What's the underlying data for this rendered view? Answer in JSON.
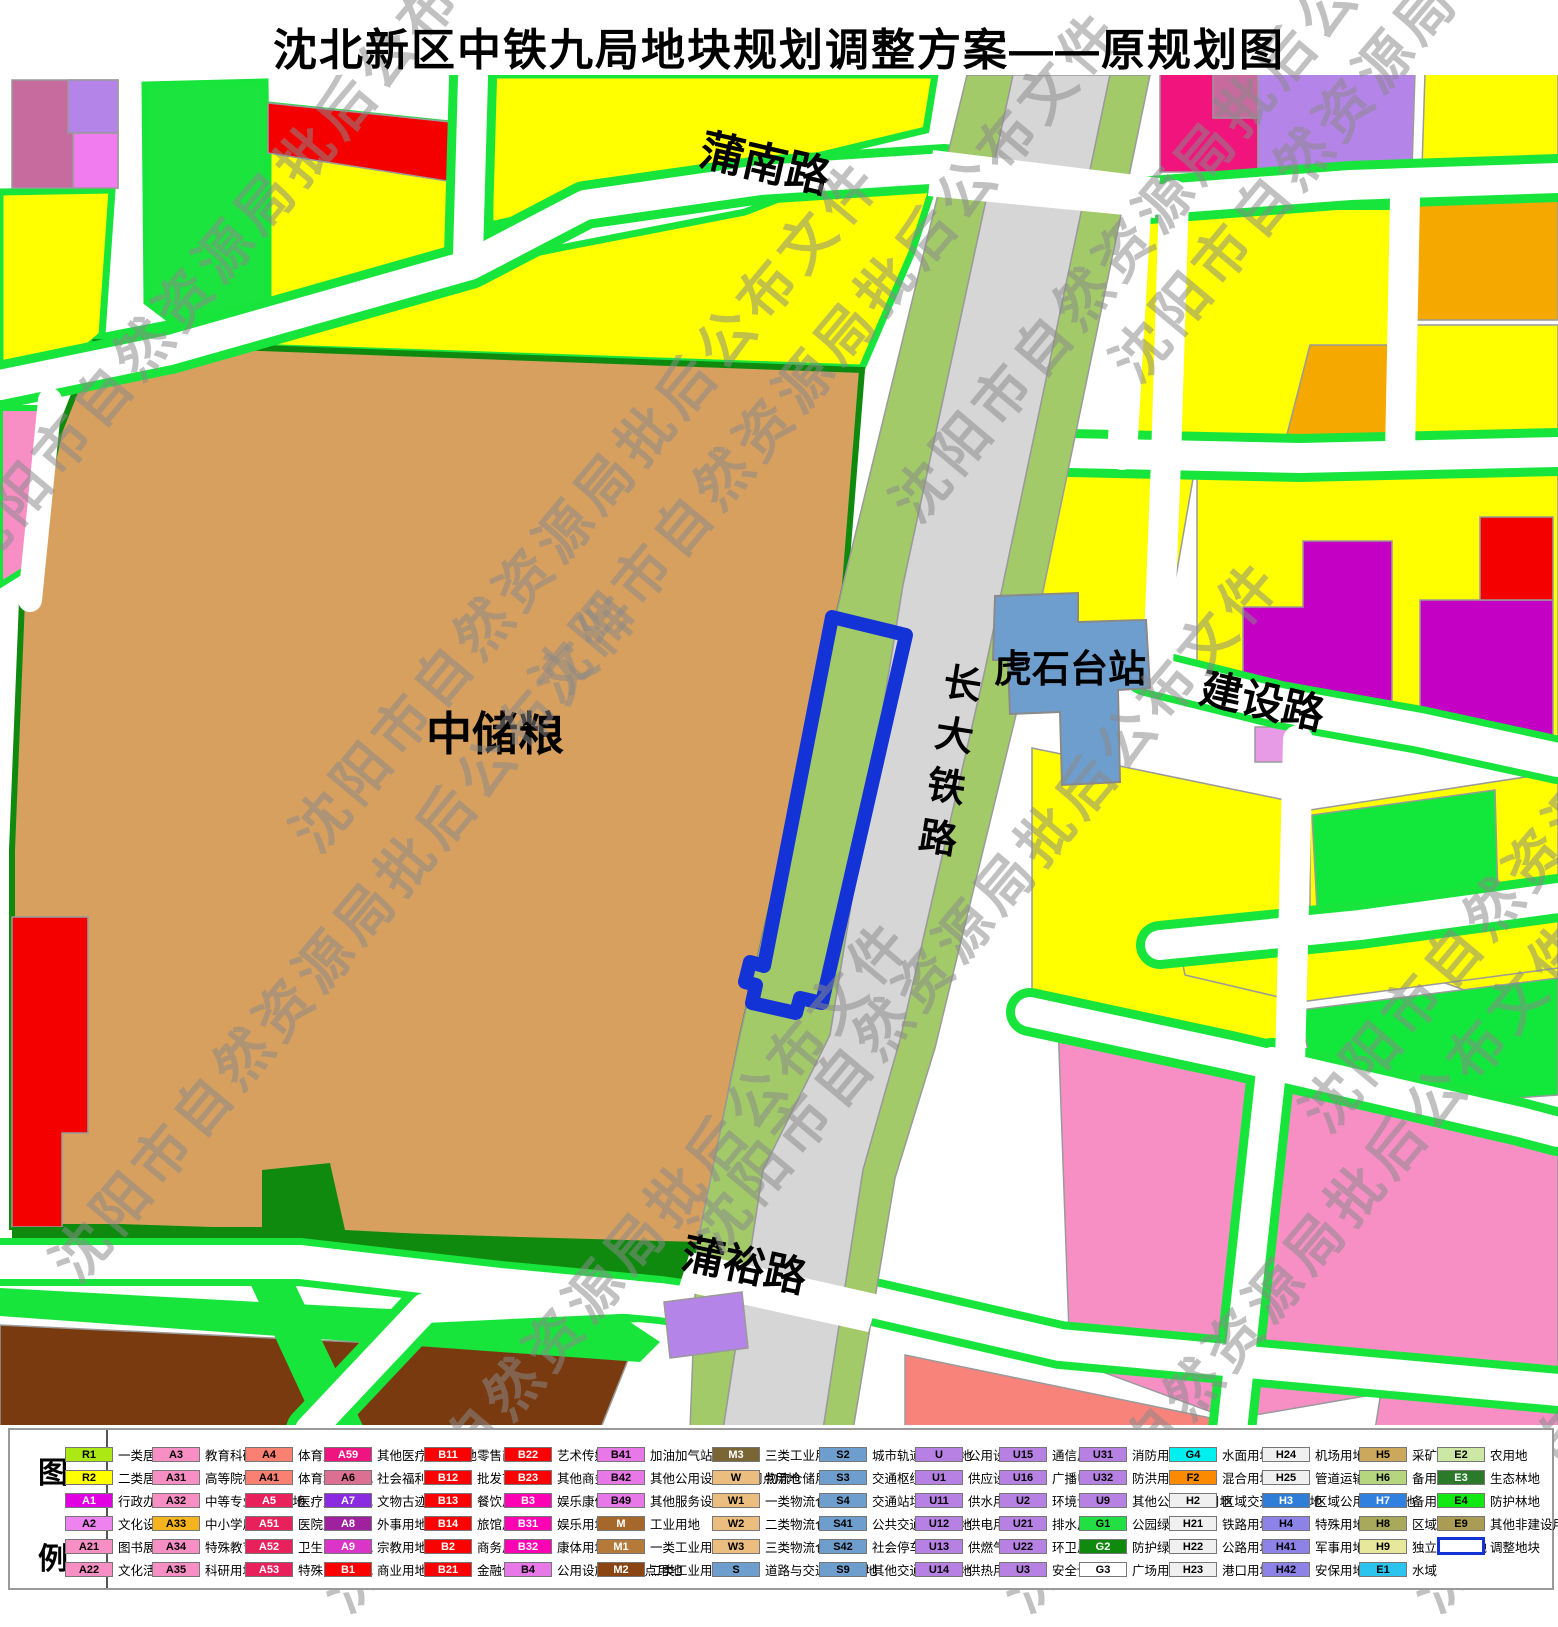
{
  "title": "沈北新区中铁九局地块规划调整方案——原规划图",
  "watermark": {
    "text": "沈阳市自然资源局批后公布文件"
  },
  "map": {
    "labels": {
      "punan_road": "蒲南路",
      "puyu_road": "蒲裕路",
      "jianshe_road": "建设路",
      "railway": "长大铁路",
      "station": "虎石台站",
      "granary": "中储粮"
    },
    "adjustment_parcel": "调整地块",
    "colors": {
      "residential_yellow": "#FFFF00",
      "granary_tan": "#D7A05F",
      "railway_gray": "#D6D6D6",
      "railway_side_green": "#A3CA69",
      "station_blue": "#6D9ECE",
      "road_edge_green": "#17E53C",
      "adjust_outline_blue": "#1433D6",
      "pink_block": "#F78FC5",
      "magenta_block": "#C400C4",
      "brown_block": "#7A3A0F",
      "red_block": "#F50000",
      "orange_block": "#F5A800"
    }
  },
  "legend": {
    "heading_top": "图",
    "heading_bottom": "例",
    "columns": [
      [
        {
          "c": "R1",
          "l": "一类居住用地",
          "f": "#ACE814"
        },
        {
          "c": "R2",
          "l": "二类居住用地",
          "f": "#FFFF00"
        },
        {
          "c": "A1",
          "l": "行政办公用地",
          "f": "#E100E1",
          "t": "#fff"
        },
        {
          "c": "A2",
          "l": "文化设施用地",
          "f": "#EE82EE"
        },
        {
          "c": "A21",
          "l": "图书展览用地",
          "f": "#F78FC5"
        },
        {
          "c": "A22",
          "l": "文化活动用地",
          "f": "#F78FC5"
        }
      ],
      [
        {
          "c": "A3",
          "l": "教育科研用地",
          "f": "#F78FC5"
        },
        {
          "c": "A31",
          "l": "高等院校用地",
          "f": "#F78FC5"
        },
        {
          "c": "A32",
          "l": "中等专业学校用地",
          "f": "#F78FC5"
        },
        {
          "c": "A33",
          "l": "中小学用地",
          "f": "#F5B41E"
        },
        {
          "c": "A34",
          "l": "特殊教育用地",
          "f": "#F78FC5"
        },
        {
          "c": "A35",
          "l": "科研用地",
          "f": "#F78FC5"
        }
      ],
      [
        {
          "c": "A4",
          "l": "体育用地",
          "f": "#FA8072"
        },
        {
          "c": "A41",
          "l": "体育场馆用地",
          "f": "#FA8072"
        },
        {
          "c": "A5",
          "l": "医疗卫生用地",
          "f": "#E8205C",
          "t": "#fff"
        },
        {
          "c": "A51",
          "l": "医院用地",
          "f": "#E8205C",
          "t": "#fff"
        },
        {
          "c": "A52",
          "l": "卫生防疫用地",
          "f": "#E8205C",
          "t": "#fff"
        },
        {
          "c": "A53",
          "l": "特殊医疗用地",
          "f": "#E8205C",
          "t": "#fff"
        }
      ],
      [
        {
          "c": "A59",
          "l": "其他医疗卫生用地",
          "f": "#F01480",
          "t": "#fff"
        },
        {
          "c": "A6",
          "l": "社会福利用地",
          "f": "#DB7093"
        },
        {
          "c": "A7",
          "l": "文物古迹用地",
          "f": "#8A2BE2",
          "t": "#fff"
        },
        {
          "c": "A8",
          "l": "外事用地",
          "f": "#A021A0",
          "t": "#fff"
        },
        {
          "c": "A9",
          "l": "宗教用地",
          "f": "#DA35C8",
          "t": "#fff"
        },
        {
          "c": "B1",
          "l": "商业用地",
          "f": "#FF0000",
          "t": "#fff"
        }
      ],
      [
        {
          "c": "B11",
          "l": "零售商业用地",
          "f": "#FF0000",
          "t": "#fff"
        },
        {
          "c": "B12",
          "l": "批发市场用地",
          "f": "#FF0000",
          "t": "#fff"
        },
        {
          "c": "B13",
          "l": "餐饮用地",
          "f": "#FF0000",
          "t": "#fff"
        },
        {
          "c": "B14",
          "l": "旅馆用地",
          "f": "#FF0000",
          "t": "#fff"
        },
        {
          "c": "B2",
          "l": "商务用地",
          "f": "#FF0000",
          "t": "#fff"
        },
        {
          "c": "B21",
          "l": "金融保险用地",
          "f": "#FF0000",
          "t": "#fff"
        }
      ],
      [
        {
          "c": "B22",
          "l": "艺术传媒用地",
          "f": "#FF0000",
          "t": "#fff"
        },
        {
          "c": "B23",
          "l": "其他商务用地",
          "f": "#FF0000",
          "t": "#fff"
        },
        {
          "c": "B3",
          "l": "娱乐康体用地",
          "f": "#FF00B4",
          "t": "#fff"
        },
        {
          "c": "B31",
          "l": "娱乐用地",
          "f": "#FF00B4",
          "t": "#fff"
        },
        {
          "c": "B32",
          "l": "康体用地",
          "f": "#FF00B4",
          "t": "#fff"
        },
        {
          "c": "B4",
          "l": "公用设施营业网点用地",
          "f": "#E878E8"
        }
      ],
      [
        {
          "c": "B41",
          "l": "加油加气站用地",
          "f": "#E878E8"
        },
        {
          "c": "B42",
          "l": "其他公用设施营业网点用地",
          "f": "#E878E8"
        },
        {
          "c": "B49",
          "l": "其他服务设施用地",
          "f": "#E878E8"
        },
        {
          "c": "M",
          "l": "工业用地",
          "f": "#A5682A",
          "t": "#fff"
        },
        {
          "c": "M1",
          "l": "一类工业用地",
          "f": "#B5793A",
          "t": "#fff"
        },
        {
          "c": "M2",
          "l": "二类工业用地",
          "f": "#8B4513",
          "t": "#fff"
        }
      ],
      [
        {
          "c": "M3",
          "l": "三类工业用地",
          "f": "#7A6535",
          "t": "#fff"
        },
        {
          "c": "W",
          "l": "物流仓储用地",
          "f": "#EBBD7F"
        },
        {
          "c": "W1",
          "l": "一类物流仓储用地",
          "f": "#EBBD7F"
        },
        {
          "c": "W2",
          "l": "二类物流仓储用地",
          "f": "#EBBD7F"
        },
        {
          "c": "W3",
          "l": "三类物流仓储用地",
          "f": "#EBBD7F"
        },
        {
          "c": "S",
          "l": "道路与交通设施用地",
          "f": "#6D9ECE"
        }
      ],
      [
        {
          "c": "S2",
          "l": "城市轨道交通用地",
          "f": "#6D9ECE"
        },
        {
          "c": "S3",
          "l": "交通枢纽用地",
          "f": "#6D9ECE"
        },
        {
          "c": "S4",
          "l": "交通站场用地",
          "f": "#6D9ECE"
        },
        {
          "c": "S41",
          "l": "公共交通场站用地",
          "f": "#6D9ECE"
        },
        {
          "c": "S42",
          "l": "社会停车场用地",
          "f": "#6D9ECE"
        },
        {
          "c": "S9",
          "l": "其他交通设施用地",
          "f": "#6D9ECE"
        }
      ],
      [
        {
          "c": "U",
          "l": "公用设施用地",
          "f": "#B781E4"
        },
        {
          "c": "U1",
          "l": "供应设施用地",
          "f": "#B781E4"
        },
        {
          "c": "U11",
          "l": "供水用地",
          "f": "#B781E4"
        },
        {
          "c": "U12",
          "l": "供电用地",
          "f": "#B781E4"
        },
        {
          "c": "U13",
          "l": "供燃气用地",
          "f": "#B781E4"
        },
        {
          "c": "U14",
          "l": "供热用地",
          "f": "#B781E4"
        }
      ],
      [
        {
          "c": "U15",
          "l": "通信用地",
          "f": "#B781E4"
        },
        {
          "c": "U16",
          "l": "广播电视用地",
          "f": "#B781E4"
        },
        {
          "c": "U2",
          "l": "环境设施用地",
          "f": "#B781E4"
        },
        {
          "c": "U21",
          "l": "排水用地",
          "f": "#B781E4"
        },
        {
          "c": "U22",
          "l": "环卫用地",
          "f": "#B781E4"
        },
        {
          "c": "U3",
          "l": "安全设施用地",
          "f": "#B781E4"
        }
      ],
      [
        {
          "c": "U31",
          "l": "消防用地",
          "f": "#B781E4"
        },
        {
          "c": "U32",
          "l": "防洪用地",
          "f": "#B781E4"
        },
        {
          "c": "U9",
          "l": "其他公用设施用地",
          "f": "#B781E4"
        },
        {
          "c": "G1",
          "l": "公园绿地",
          "f": "#22E044"
        },
        {
          "c": "G2",
          "l": "防护绿地",
          "f": "#0F8A0F",
          "t": "#fff"
        },
        {
          "c": "G3",
          "l": "广场用地",
          "f": "#FFFFFF"
        }
      ],
      [
        {
          "c": "G4",
          "l": "水面用地",
          "f": "#00F0F0"
        },
        {
          "c": "F2",
          "l": "混合用地",
          "f": "#FB8A00"
        },
        {
          "c": "H2",
          "l": "区域交通设施用地",
          "f": "#F0F0F0"
        },
        {
          "c": "H21",
          "l": "铁路用地",
          "f": "#F0F0F0"
        },
        {
          "c": "H22",
          "l": "公路用地",
          "f": "#F0F0F0"
        },
        {
          "c": "H23",
          "l": "港口用地",
          "f": "#F0F0F0"
        }
      ],
      [
        {
          "c": "H24",
          "l": "机场用地",
          "f": "#F0F0F0"
        },
        {
          "c": "H25",
          "l": "管道运输用地",
          "f": "#F0F0F0"
        },
        {
          "c": "H3",
          "l": "区域公用设施用地",
          "f": "#2E7ED8",
          "t": "#fff"
        },
        {
          "c": "H4",
          "l": "特殊用地",
          "f": "#8C82E8"
        },
        {
          "c": "H41",
          "l": "军事用地",
          "f": "#8C82E8"
        },
        {
          "c": "H42",
          "l": "安保用地",
          "f": "#8C82E8"
        }
      ],
      [
        {
          "c": "H5",
          "l": "采矿用地",
          "f": "#CBA85C"
        },
        {
          "c": "H6",
          "l": "备用地",
          "f": "#B5D67E"
        },
        {
          "c": "H7",
          "l": "备用地",
          "f": "#3080E0",
          "t": "#fff"
        },
        {
          "c": "H8",
          "l": "区域绿地",
          "f": "#A9A95C"
        },
        {
          "c": "H9",
          "l": "独立建设用地",
          "f": "#E8E89C"
        },
        {
          "c": "E1",
          "l": "水域",
          "f": "#2BC4EE"
        }
      ],
      [
        {
          "c": "E2",
          "l": "农用地",
          "f": "#CDE8A5"
        },
        {
          "c": "E3",
          "l": "生态林地",
          "f": "#2A7A2A",
          "t": "#fff"
        },
        {
          "c": "E4",
          "l": "防护林地",
          "f": "#12E812"
        },
        {
          "c": "E9",
          "l": "其他非建设用地",
          "f": "#AB9C55"
        },
        {
          "c": "",
          "l": "调整地块",
          "f": "#FFFFFF",
          "sp": true
        }
      ]
    ]
  }
}
